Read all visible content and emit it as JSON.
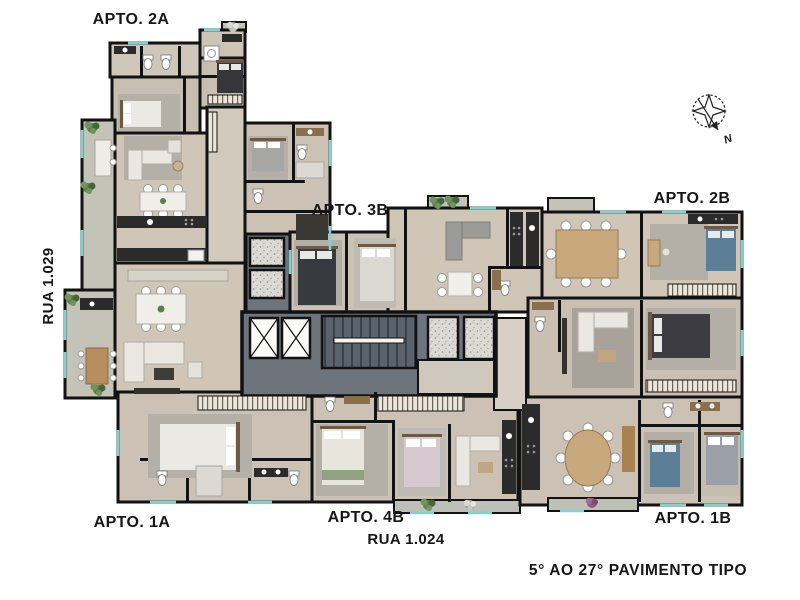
{
  "plan": {
    "type": "residential-typical-floor-plan",
    "caption": "5° AO 27° PAVIMENTO TIPO"
  },
  "apartments": {
    "a2a": "APTO. 2A",
    "a3b": "APTO. 3B",
    "a2b": "APTO. 2B",
    "a1a": "APTO. 1A",
    "a4b": "APTO. 4B",
    "a1b": "APTO. 1B"
  },
  "streets": {
    "left_vertical": "RUA 1.029",
    "bottom": "RUA 1.024"
  },
  "compass": {
    "north_label": "N"
  },
  "colors": {
    "background": "#ffffff",
    "wall": "#121212",
    "floor_beige": "#cfc6b8",
    "floor_taupe": "#c6bfb2",
    "balcony": "#c3c3b8",
    "core_slab": "#6d747b",
    "window_accent": "#7ed2d2",
    "counter_dark": "#2b2b2b",
    "wood": "#b98e5f",
    "plant_green": "#5e7f4d",
    "plant_purple": "#8e5a83",
    "label_text": "#161616"
  }
}
